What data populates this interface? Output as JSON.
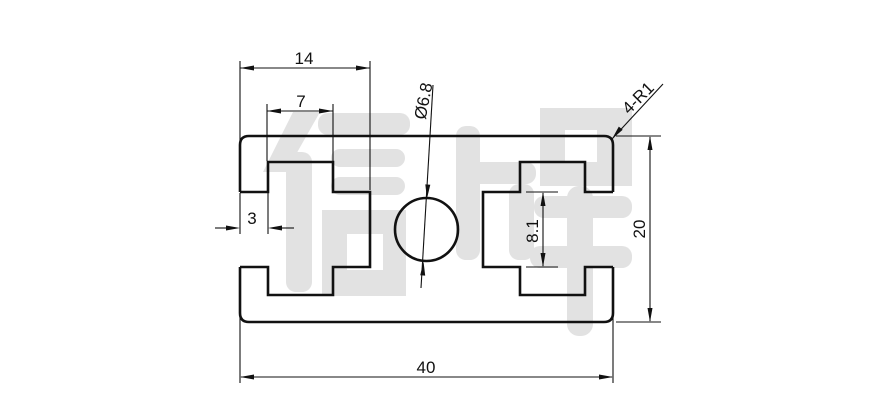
{
  "drawing": {
    "type": "aluminum-extrusion-profile-cross-section",
    "watermark": {
      "text": "信牌",
      "color": "#e2e2e2"
    },
    "colors": {
      "line": "#111111",
      "background": "#ffffff"
    },
    "dimensions": {
      "slot_depth": "14",
      "chamber_width": "7",
      "hole_diameter": "Ø6.8",
      "corner_radius": "4-R1",
      "opening_depth": "3",
      "slot_height": "8.1",
      "profile_height": "20",
      "profile_width": "40"
    }
  }
}
